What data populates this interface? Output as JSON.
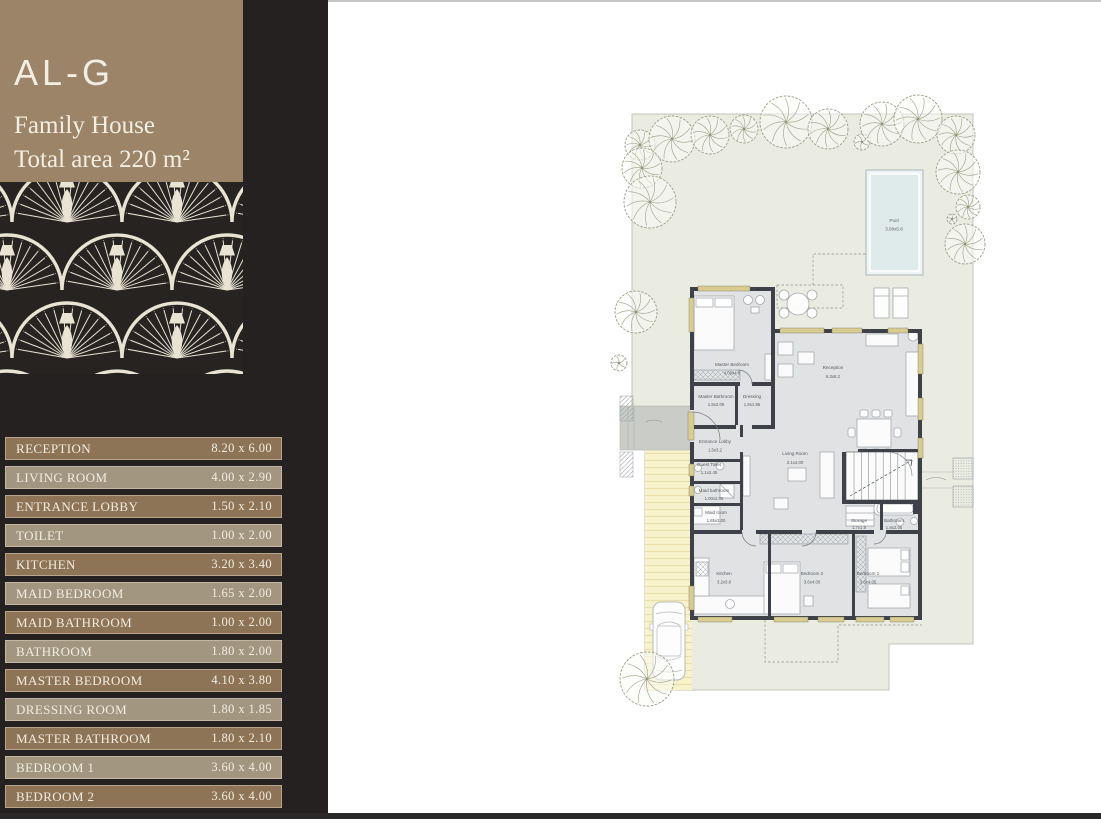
{
  "sidebar": {
    "unit_code": "AL-G",
    "unit_type": "Family House",
    "total_area": "Total area 220 m²",
    "rooms": [
      {
        "label": "RECEPTION",
        "dims": "8.20 x 6.00"
      },
      {
        "label": "LIVING ROOM",
        "dims": "4.00 x 2.90"
      },
      {
        "label": "ENTRANCE LOBBY",
        "dims": "1.50 x 2.10"
      },
      {
        "label": "TOILET",
        "dims": "1.00 x 2.00"
      },
      {
        "label": "KITCHEN",
        "dims": "3.20 x 3.40"
      },
      {
        "label": "MAID BEDROOM",
        "dims": "1.65 x 2.00"
      },
      {
        "label": "MAID BATHROOM",
        "dims": "1.00 x 2.00"
      },
      {
        "label": "BATHROOM",
        "dims": "1.80 x 2.00"
      },
      {
        "label": "MASTER BEDROOM",
        "dims": "4.10 x 3.80"
      },
      {
        "label": "DRESSING ROOM",
        "dims": "1.80 x 1.85"
      },
      {
        "label": "MASTER BATHROOM",
        "dims": "1.80 x 2.10"
      },
      {
        "label": "BEDROOM 1",
        "dims": "3.60 x 4.00"
      },
      {
        "label": "BEDROOM 2",
        "dims": "3.60 x 4.00"
      }
    ]
  },
  "plan": {
    "labels": [
      {
        "name": "Master Bedroom",
        "dims": "4.00x4.8"
      },
      {
        "name": "Reception",
        "dims": "6.3x8.2"
      },
      {
        "name": "Dressing",
        "dims": "1.8x1.85"
      },
      {
        "name": "Master Bathroom",
        "dims": "1.8x2.05"
      },
      {
        "name": "Entrance Lobby",
        "dims": "1.5x3.2"
      },
      {
        "name": "Guest Toilet",
        "dims": "1.1x2.45"
      },
      {
        "name": "Living Room",
        "dims": "3.1x4.00"
      },
      {
        "name": "Maid bathroom",
        "dims": "1.00x2.00"
      },
      {
        "name": "Maid room",
        "dims": "1.65x2.00"
      },
      {
        "name": "Kitchen",
        "dims": "3.2x3.8"
      },
      {
        "name": "Bedroom 2",
        "dims": "3.6x4.00"
      },
      {
        "name": "Bedroom 1",
        "dims": "3.6x4.05"
      },
      {
        "name": "Storage",
        "dims": "1.7x1.8"
      },
      {
        "name": "Bathroom",
        "dims": "1.8x2.05"
      },
      {
        "name": "Pool",
        "dims": "3.00x5.8"
      }
    ]
  },
  "colors": {
    "sidebar_bg": "#242120",
    "header_bg": "#9c8468",
    "row_dark": "#8e7457",
    "row_light": "#a29681",
    "text_cream": "#f1ecdf",
    "plot_green": "#eaece2",
    "pool_blue": "#dfeaea",
    "wall": "#3e4248",
    "window_khaki": "#d9cc90",
    "driveway_yellow": "#f7f2cc"
  }
}
